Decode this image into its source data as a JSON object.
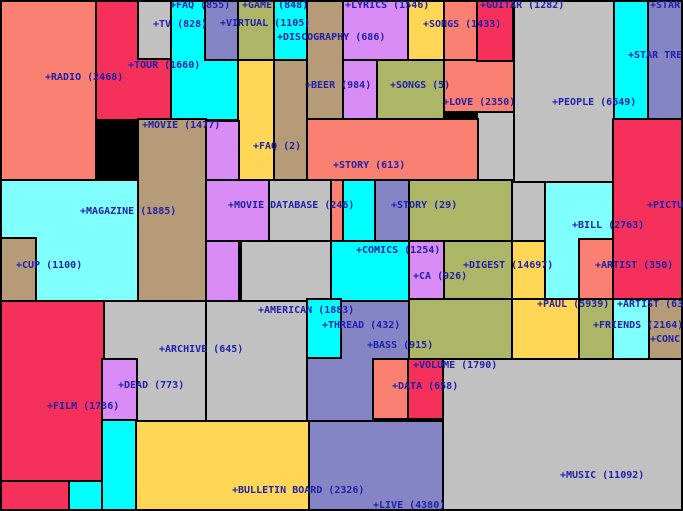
{
  "title": "category-map",
  "text_color": "#2121AA",
  "palette": {
    "salmon": "#FA8072",
    "crimson": "#F5305A",
    "cyan": "#00FFFF",
    "palecyan": "#80FFFF",
    "gray": "#C1C1C1",
    "slate": "#8585C6",
    "violet": "#D98CF5",
    "olive": "#ACB666",
    "tan": "#B59B77",
    "yellow": "#FFD655"
  },
  "chart_data": {
    "type": "heatmap",
    "subtype": "som-category-map (rectangular labeled regions with document counts)",
    "title": "",
    "categories": [
      "RADIO",
      "TOUR",
      "TV",
      "FAQ",
      "VIRTUAL",
      "GAME",
      "DISCOGRAPHY",
      "LYRICS",
      "BEER",
      "SONGS",
      "SONGS",
      "GUITAR",
      "LOVE",
      "PEOPLE",
      "STAR",
      "STAR TRE",
      "MOVIE",
      "FAQ",
      "STORY",
      "MAGAZINE",
      "MOVIE DATABASE",
      "STORY",
      "PICTU",
      "BILL",
      "CUP",
      "COMICS",
      "CA",
      "DIGEST",
      "ARTIST",
      "PAUL",
      "ARTIST",
      "AMERICAN",
      "THREAD",
      "FRIENDS",
      "CONC",
      "BASS",
      "ARCHIVE",
      "VOLUME",
      "DEAD",
      "DATA",
      "FILM",
      "MUSIC",
      "BULLETIN BOARD",
      "LIVE"
    ],
    "values": [
      2468,
      1660,
      828,
      855,
      1105,
      848,
      686,
      1546,
      984,
      1433,
      5,
      1282,
      2350,
      6649,
      null,
      null,
      1477,
      2,
      613,
      1885,
      246,
      29,
      null,
      2763,
      1100,
      1254,
      926,
      14697,
      350,
      5939,
      63,
      1883,
      432,
      2164,
      null,
      915,
      645,
      1790,
      773,
      658,
      1736,
      11092,
      2326,
      4380
    ],
    "legend_position": "none",
    "grid": false
  },
  "map": {
    "tiles": [
      {
        "n": "radio",
        "x": 0,
        "y": 0,
        "w": 97,
        "h": 181,
        "c": "salmon"
      },
      {
        "n": "tour",
        "x": 95,
        "y": 0,
        "w": 77,
        "h": 121,
        "c": "crimson"
      },
      {
        "n": "faq",
        "x": 170,
        "y": 0,
        "w": 69,
        "h": 121,
        "c": "cyan"
      },
      {
        "n": "game",
        "x": 237,
        "y": 0,
        "w": 38,
        "h": 61,
        "c": "olive"
      },
      {
        "n": "faq2-strip",
        "x": 237,
        "y": 59,
        "w": 38,
        "h": 122,
        "c": "yellow"
      },
      {
        "n": "discography",
        "x": 273,
        "y": 0,
        "w": 37,
        "h": 61,
        "c": "cyan"
      },
      {
        "n": "beer-top",
        "x": 306,
        "y": 0,
        "w": 38,
        "h": 120,
        "c": "tan"
      },
      {
        "n": "beer-left",
        "x": 273,
        "y": 59,
        "w": 35,
        "h": 122,
        "c": "tan"
      },
      {
        "n": "lyrics-top",
        "x": 342,
        "y": 0,
        "w": 68,
        "h": 61,
        "c": "violet"
      },
      {
        "n": "lyrics-col",
        "x": 342,
        "y": 59,
        "w": 36,
        "h": 62,
        "c": "violet"
      },
      {
        "n": "songs5",
        "x": 376,
        "y": 59,
        "w": 69,
        "h": 63,
        "c": "olive"
      },
      {
        "n": "love-top",
        "x": 443,
        "y": 0,
        "w": 35,
        "h": 61,
        "c": "salmon"
      },
      {
        "n": "love-main",
        "x": 443,
        "y": 59,
        "w": 72,
        "h": 54,
        "c": "salmon"
      },
      {
        "n": "people",
        "x": 513,
        "y": 0,
        "w": 102,
        "h": 183,
        "c": "gray"
      },
      {
        "n": "people-col",
        "x": 476,
        "y": 111,
        "w": 39,
        "h": 72,
        "c": "gray"
      },
      {
        "n": "people-mid",
        "x": 509,
        "y": 181,
        "w": 38,
        "h": 62,
        "c": "gray"
      },
      {
        "n": "startrek-cyan",
        "x": 613,
        "y": 0,
        "w": 36,
        "h": 120,
        "c": "cyan"
      },
      {
        "n": "star-slate",
        "x": 647,
        "y": 0,
        "w": 36,
        "h": 120,
        "c": "slate"
      },
      {
        "n": "picture",
        "x": 612,
        "y": 118,
        "w": 71,
        "h": 184,
        "c": "crimson"
      },
      {
        "n": "story613",
        "x": 306,
        "y": 118,
        "w": 173,
        "h": 63,
        "c": "salmon"
      },
      {
        "n": "story-arm",
        "x": 330,
        "y": 179,
        "w": 14,
        "h": 63,
        "c": "salmon"
      },
      {
        "n": "movie",
        "x": 137,
        "y": 118,
        "w": 70,
        "h": 184,
        "c": "tan"
      },
      {
        "n": "md-col",
        "x": 205,
        "y": 120,
        "w": 35,
        "h": 182,
        "c": "violet"
      },
      {
        "n": "md-wide",
        "x": 205,
        "y": 179,
        "w": 65,
        "h": 63,
        "c": "violet"
      },
      {
        "n": "am-up1",
        "x": 268,
        "y": 179,
        "w": 64,
        "h": 63,
        "c": "gray"
      },
      {
        "n": "am-up2",
        "x": 240,
        "y": 240,
        "w": 92,
        "h": 62,
        "c": "gray"
      },
      {
        "n": "magazine",
        "x": 0,
        "y": 179,
        "w": 139,
        "h": 123,
        "c": "palecyan"
      },
      {
        "n": "digest-top",
        "x": 408,
        "y": 179,
        "w": 105,
        "h": 63,
        "c": "olive"
      },
      {
        "n": "digest-mid",
        "x": 443,
        "y": 240,
        "w": 70,
        "h": 60,
        "c": "olive"
      },
      {
        "n": "digest-low",
        "x": 408,
        "y": 298,
        "w": 107,
        "h": 62,
        "c": "olive"
      },
      {
        "n": "paul-strip",
        "x": 511,
        "y": 240,
        "w": 36,
        "h": 60,
        "c": "yellow"
      },
      {
        "n": "bill",
        "x": 544,
        "y": 181,
        "w": 70,
        "h": 119,
        "c": "palecyan"
      },
      {
        "n": "paul-main",
        "x": 511,
        "y": 298,
        "w": 69,
        "h": 62,
        "c": "yellow"
      },
      {
        "n": "olive-strip",
        "x": 578,
        "y": 298,
        "w": 36,
        "h": 62,
        "c": "olive"
      },
      {
        "n": "friends",
        "x": 612,
        "y": 298,
        "w": 38,
        "h": 62,
        "c": "palecyan"
      },
      {
        "n": "artist63-tan",
        "x": 648,
        "y": 298,
        "w": 35,
        "h": 62,
        "c": "tan"
      },
      {
        "n": "film",
        "x": 0,
        "y": 300,
        "w": 105,
        "h": 182,
        "c": "crimson"
      },
      {
        "n": "film-low",
        "x": 0,
        "y": 480,
        "w": 70,
        "h": 31,
        "c": "crimson"
      },
      {
        "n": "archive",
        "x": 103,
        "y": 300,
        "w": 104,
        "h": 122,
        "c": "gray"
      },
      {
        "n": "american",
        "x": 205,
        "y": 300,
        "w": 103,
        "h": 122,
        "c": "gray"
      },
      {
        "n": "bass",
        "x": 306,
        "y": 298,
        "w": 104,
        "h": 124,
        "c": "slate"
      },
      {
        "n": "music",
        "x": 442,
        "y": 358,
        "w": 241,
        "h": 153,
        "c": "gray"
      },
      {
        "n": "bulletin",
        "x": 135,
        "y": 420,
        "w": 175,
        "h": 91,
        "c": "yellow"
      },
      {
        "n": "live",
        "x": 308,
        "y": 420,
        "w": 136,
        "h": 91,
        "c": "slate"
      },
      {
        "n": "comics-up",
        "x": 342,
        "y": 179,
        "w": 34,
        "h": 63,
        "c": "cyan"
      },
      {
        "n": "comics-low",
        "x": 330,
        "y": 240,
        "w": 80,
        "h": 62,
        "c": "cyan"
      },
      {
        "n": "tv",
        "x": 137,
        "y": 0,
        "w": 35,
        "h": 60,
        "c": "gray"
      },
      {
        "n": "virtual",
        "x": 204,
        "y": 0,
        "w": 35,
        "h": 61,
        "c": "slate"
      },
      {
        "n": "songs1433",
        "x": 407,
        "y": 0,
        "w": 38,
        "h": 61,
        "c": "yellow"
      },
      {
        "n": "guitar",
        "x": 476,
        "y": 0,
        "w": 38,
        "h": 62,
        "c": "crimson"
      },
      {
        "n": "cup",
        "x": 0,
        "y": 237,
        "w": 37,
        "h": 65,
        "c": "tan"
      },
      {
        "n": "story29",
        "x": 374,
        "y": 179,
        "w": 36,
        "h": 63,
        "c": "slate"
      },
      {
        "n": "ca",
        "x": 408,
        "y": 240,
        "w": 37,
        "h": 60,
        "c": "violet"
      },
      {
        "n": "artist350",
        "x": 578,
        "y": 238,
        "w": 36,
        "h": 62,
        "c": "salmon"
      },
      {
        "n": "thread",
        "x": 306,
        "y": 298,
        "w": 36,
        "h": 61,
        "c": "cyan"
      },
      {
        "n": "dead",
        "x": 101,
        "y": 358,
        "w": 37,
        "h": 63,
        "c": "violet"
      },
      {
        "n": "cyan-bl1",
        "x": 101,
        "y": 419,
        "w": 36,
        "h": 92,
        "c": "cyan"
      },
      {
        "n": "cyan-bl2",
        "x": 68,
        "y": 480,
        "w": 35,
        "h": 31,
        "c": "cyan"
      },
      {
        "n": "data",
        "x": 372,
        "y": 358,
        "w": 37,
        "h": 62,
        "c": "salmon"
      },
      {
        "n": "volume-box",
        "x": 407,
        "y": 358,
        "w": 37,
        "h": 62,
        "c": "crimson"
      }
    ],
    "labels": [
      {
        "t": "+FAQ (855)",
        "x": 170,
        "y": 3
      },
      {
        "t": "+GAME (848)",
        "x": 242,
        "y": 3
      },
      {
        "t": "+LYRICS (1546)",
        "x": 345,
        "y": 3
      },
      {
        "t": "+GUITAR (1282)",
        "x": 480,
        "y": 3
      },
      {
        "t": "+STAR",
        "x": 650,
        "y": 3
      },
      {
        "t": "+TV (828)",
        "x": 153,
        "y": 22
      },
      {
        "t": "+VIRTUAL (1105)",
        "x": 220,
        "y": 21
      },
      {
        "t": "+SONGS (1433)",
        "x": 423,
        "y": 22
      },
      {
        "t": "+DISCOGRAPHY (686)",
        "x": 277,
        "y": 35
      },
      {
        "t": "+STAR TRE",
        "x": 628,
        "y": 53
      },
      {
        "t": "+TOUR (1660)",
        "x": 128,
        "y": 63
      },
      {
        "t": "+RADIO (2468)",
        "x": 45,
        "y": 75
      },
      {
        "t": "+BEER (984)",
        "x": 305,
        "y": 83
      },
      {
        "t": "+SONGS (5)",
        "x": 390,
        "y": 83
      },
      {
        "t": "+LOVE (2350)",
        "x": 443,
        "y": 100
      },
      {
        "t": "+PEOPLE (6649)",
        "x": 552,
        "y": 100
      },
      {
        "t": "+MOVIE (1477)",
        "x": 142,
        "y": 123
      },
      {
        "t": "+FAQ (2)",
        "x": 253,
        "y": 144
      },
      {
        "t": "+STORY (613)",
        "x": 333,
        "y": 163
      },
      {
        "t": "+MOVIE DATABASE (246)",
        "x": 228,
        "y": 203
      },
      {
        "t": "+STORY (29)",
        "x": 391,
        "y": 203
      },
      {
        "t": "+PICTU",
        "x": 647,
        "y": 203
      },
      {
        "t": "+MAGAZINE (1885)",
        "x": 80,
        "y": 209
      },
      {
        "t": "+BILL (2763)",
        "x": 572,
        "y": 223
      },
      {
        "t": "+COMICS (1254)",
        "x": 356,
        "y": 248
      },
      {
        "t": "+CUP (1100)",
        "x": 16,
        "y": 263
      },
      {
        "t": "+DIGEST (14697)",
        "x": 463,
        "y": 263
      },
      {
        "t": "+ARTIST (350)",
        "x": 595,
        "y": 263
      },
      {
        "t": "+CA (926)",
        "x": 413,
        "y": 274
      },
      {
        "t": "+PAUL (5939)",
        "x": 537,
        "y": 302
      },
      {
        "t": "+ARTIST (63",
        "x": 617,
        "y": 302
      },
      {
        "t": "+AMERICAN (1883)",
        "x": 258,
        "y": 308
      },
      {
        "t": "+THREAD (432)",
        "x": 322,
        "y": 323
      },
      {
        "t": "+FRIENDS (2164)",
        "x": 593,
        "y": 323
      },
      {
        "t": "+CONC",
        "x": 650,
        "y": 337
      },
      {
        "t": "+BASS (915)",
        "x": 367,
        "y": 343
      },
      {
        "t": "+ARCHIVE (645)",
        "x": 159,
        "y": 347
      },
      {
        "t": "+VOLUME (1790)",
        "x": 413,
        "y": 363
      },
      {
        "t": "+DEAD (773)",
        "x": 118,
        "y": 383
      },
      {
        "t": "+DATA (658)",
        "x": 392,
        "y": 384
      },
      {
        "t": "+FILM (1736)",
        "x": 47,
        "y": 404
      },
      {
        "t": "+MUSIC (11092)",
        "x": 560,
        "y": 473
      },
      {
        "t": "+BULLETIN BOARD (2326)",
        "x": 232,
        "y": 488
      },
      {
        "t": "+LIVE (4380)",
        "x": 373,
        "y": 503
      }
    ]
  }
}
